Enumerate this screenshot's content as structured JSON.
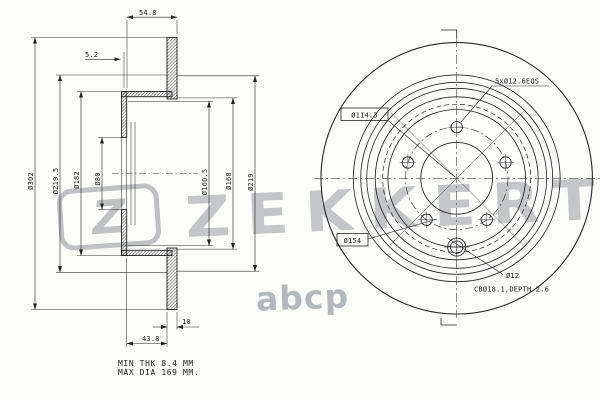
{
  "watermark": {
    "logo_letter": "Z",
    "brand": "ZEKKERT",
    "marketplace": "abcp"
  },
  "section_view": {
    "dim_width_total": "54.8",
    "dim_flange_thickness": "5.2",
    "dim_outer_diameter": "Ø302",
    "dim_d219_5": "Ø219.5",
    "dim_d182": "Ø182",
    "dim_center_bore": "Ø80",
    "dim_d160_5": "Ø160.5",
    "dim_d168": "Ø168",
    "dim_d219": "Ø219",
    "dim_offset": "43.8",
    "dim_disc_thickness": "10",
    "note_min_thickness": "MIN THK 8.4 MM",
    "note_max_diameter": "MAX DIA 169 MM."
  },
  "front_view": {
    "label_bolt_holes": "5xØ12.6EQS",
    "label_bolt_circle": "Ø114.3",
    "label_pin_circle": "Ø154",
    "label_pin_hole": "Ø12",
    "label_counterbore": "CBØ18.1,DEPTH 2.6"
  }
}
